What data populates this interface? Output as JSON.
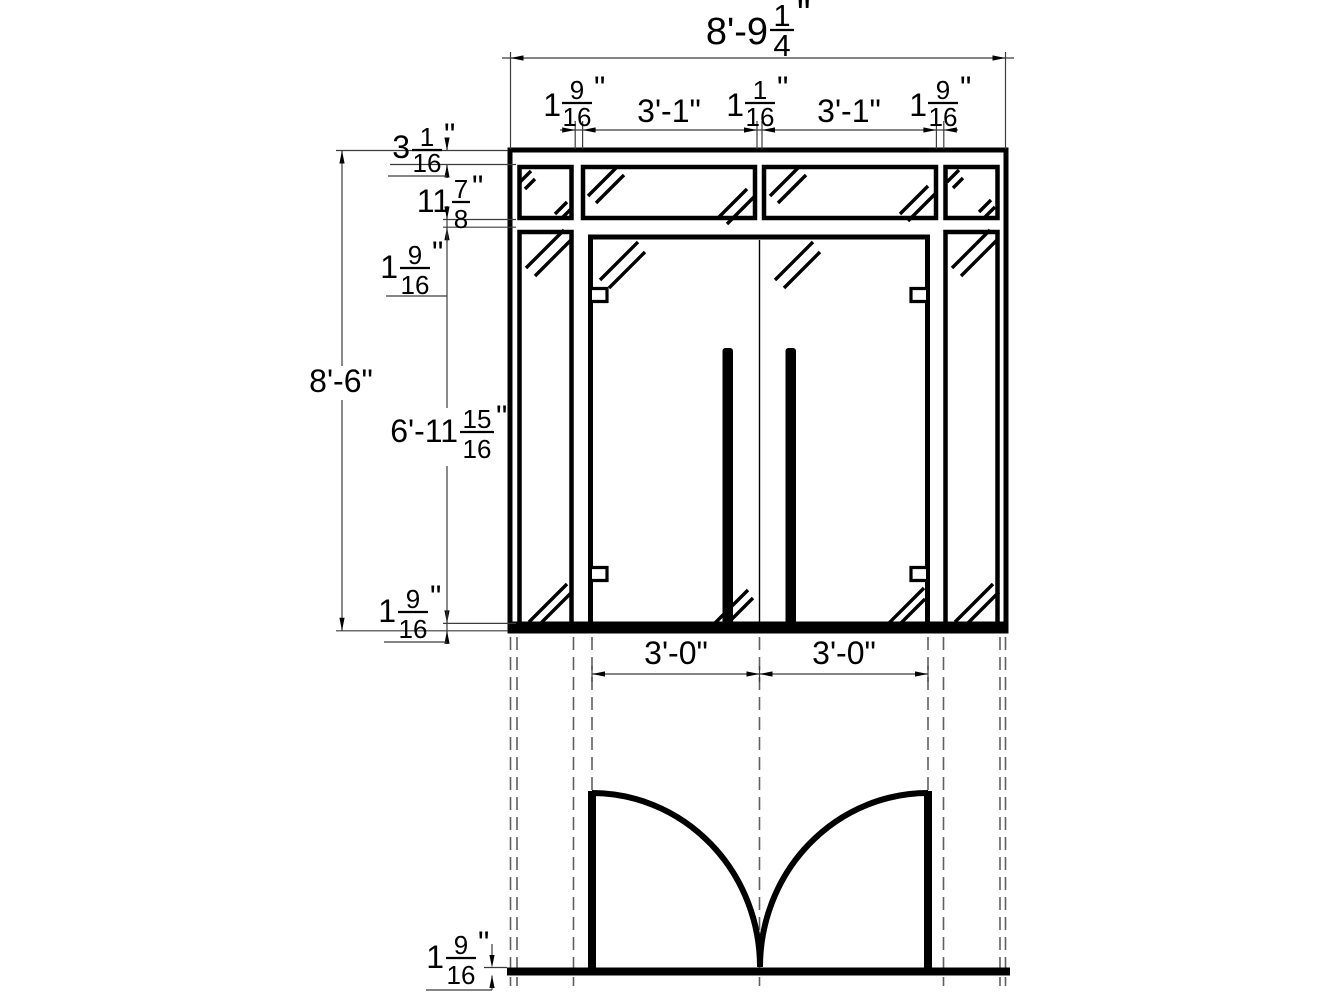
{
  "drawing": {
    "type": "door-entrance-elevation-and-plan",
    "colors": {
      "line": "#000000",
      "dimension_line": "#3c3c3c",
      "projection_line": "#5f5f5f",
      "background": "#ffffff"
    },
    "dims": {
      "overall_width": {
        "whole": "8'-9",
        "num": "1",
        "den": "4",
        "unit": "\""
      },
      "jamb_left": {
        "whole": "1",
        "num": "9",
        "den": "16",
        "unit": "\""
      },
      "panel_left": {
        "text": "3'-1\""
      },
      "jamb_center": {
        "whole": "1",
        "num": "1",
        "den": "16",
        "unit": "\""
      },
      "panel_right": {
        "text": "3'-1\""
      },
      "jamb_right": {
        "whole": "1",
        "num": "9",
        "den": "16",
        "unit": "\""
      },
      "head_frame": {
        "whole": "3",
        "num": "1",
        "den": "16",
        "unit": "\""
      },
      "transom_height": {
        "whole": "11",
        "num": "7",
        "den": "8",
        "unit": "\""
      },
      "transom_gap": {
        "whole": "1",
        "num": "9",
        "den": "16",
        "unit": "\""
      },
      "overall_height": {
        "text": "8'-6\""
      },
      "door_height": {
        "whole": "6'-11",
        "num": "15",
        "den": "16",
        "unit": "\""
      },
      "bottom_gap": {
        "whole": "1",
        "num": "9",
        "den": "16",
        "unit": "\""
      },
      "plan_door_left": {
        "text": "3'-0\""
      },
      "plan_door_right": {
        "text": "3'-0\""
      },
      "sill_thickness": {
        "whole": "1",
        "num": "9",
        "den": "16",
        "unit": "\""
      }
    }
  }
}
